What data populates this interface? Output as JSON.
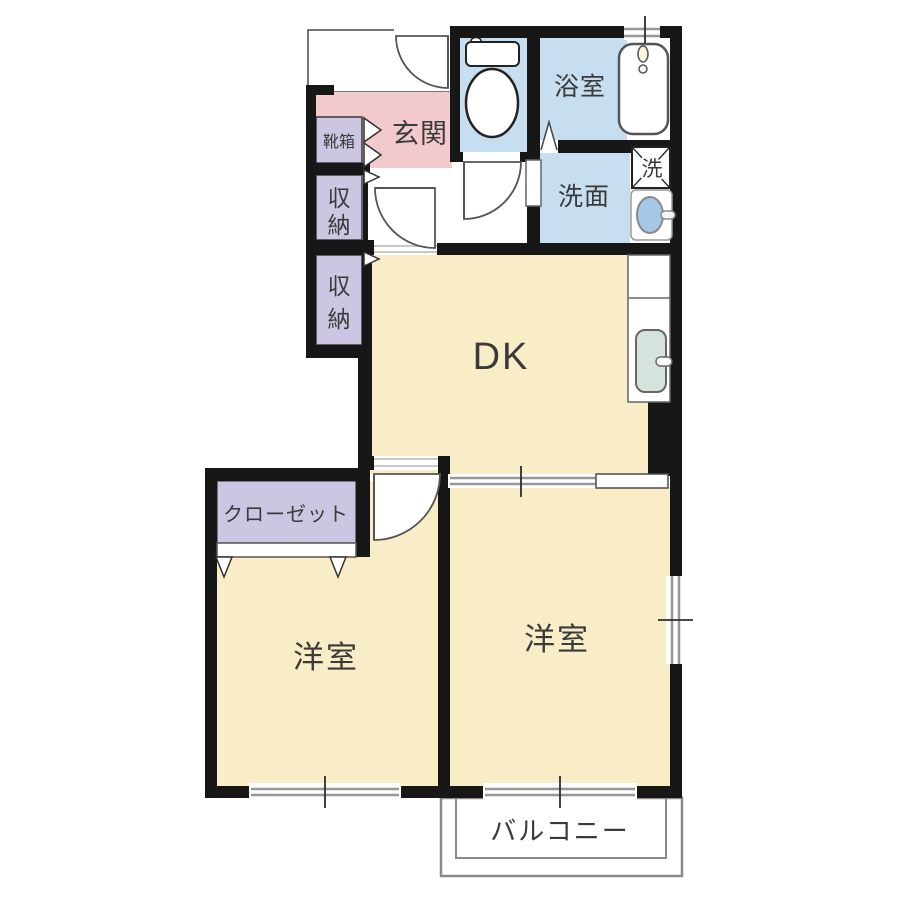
{
  "title": "2DK間取り図",
  "labels": {
    "genkan": "玄関",
    "shoebox": "靴箱",
    "storage1": "収納",
    "storage2": "収納",
    "bath": "浴室",
    "washroom": "洗面",
    "washer": "洗",
    "dk": "DK",
    "closet": "クローゼット",
    "west_room_left": "洋室",
    "west_room_right": "洋室",
    "balcony": "バルコニー"
  },
  "colors": {
    "wall": "#171717",
    "room_cream": "#F9EDC8",
    "wet_area_blue": "#C7DDF0",
    "entry_pink": "#F2CACD",
    "storage_purple": "#CCC6E2",
    "kitchen_sink_green": "#D6E2DC",
    "basin_blue": "#A5C8E8",
    "tub_white": "#FFFFFF",
    "faucet_cream": "#FBF6DC"
  },
  "fixtures": {
    "toilet": "toilet",
    "bathtub": "bathtub",
    "washing_machine": "washing-machine",
    "wash_basin": "wash-basin",
    "kitchen_sink": "kitchen-sink"
  }
}
